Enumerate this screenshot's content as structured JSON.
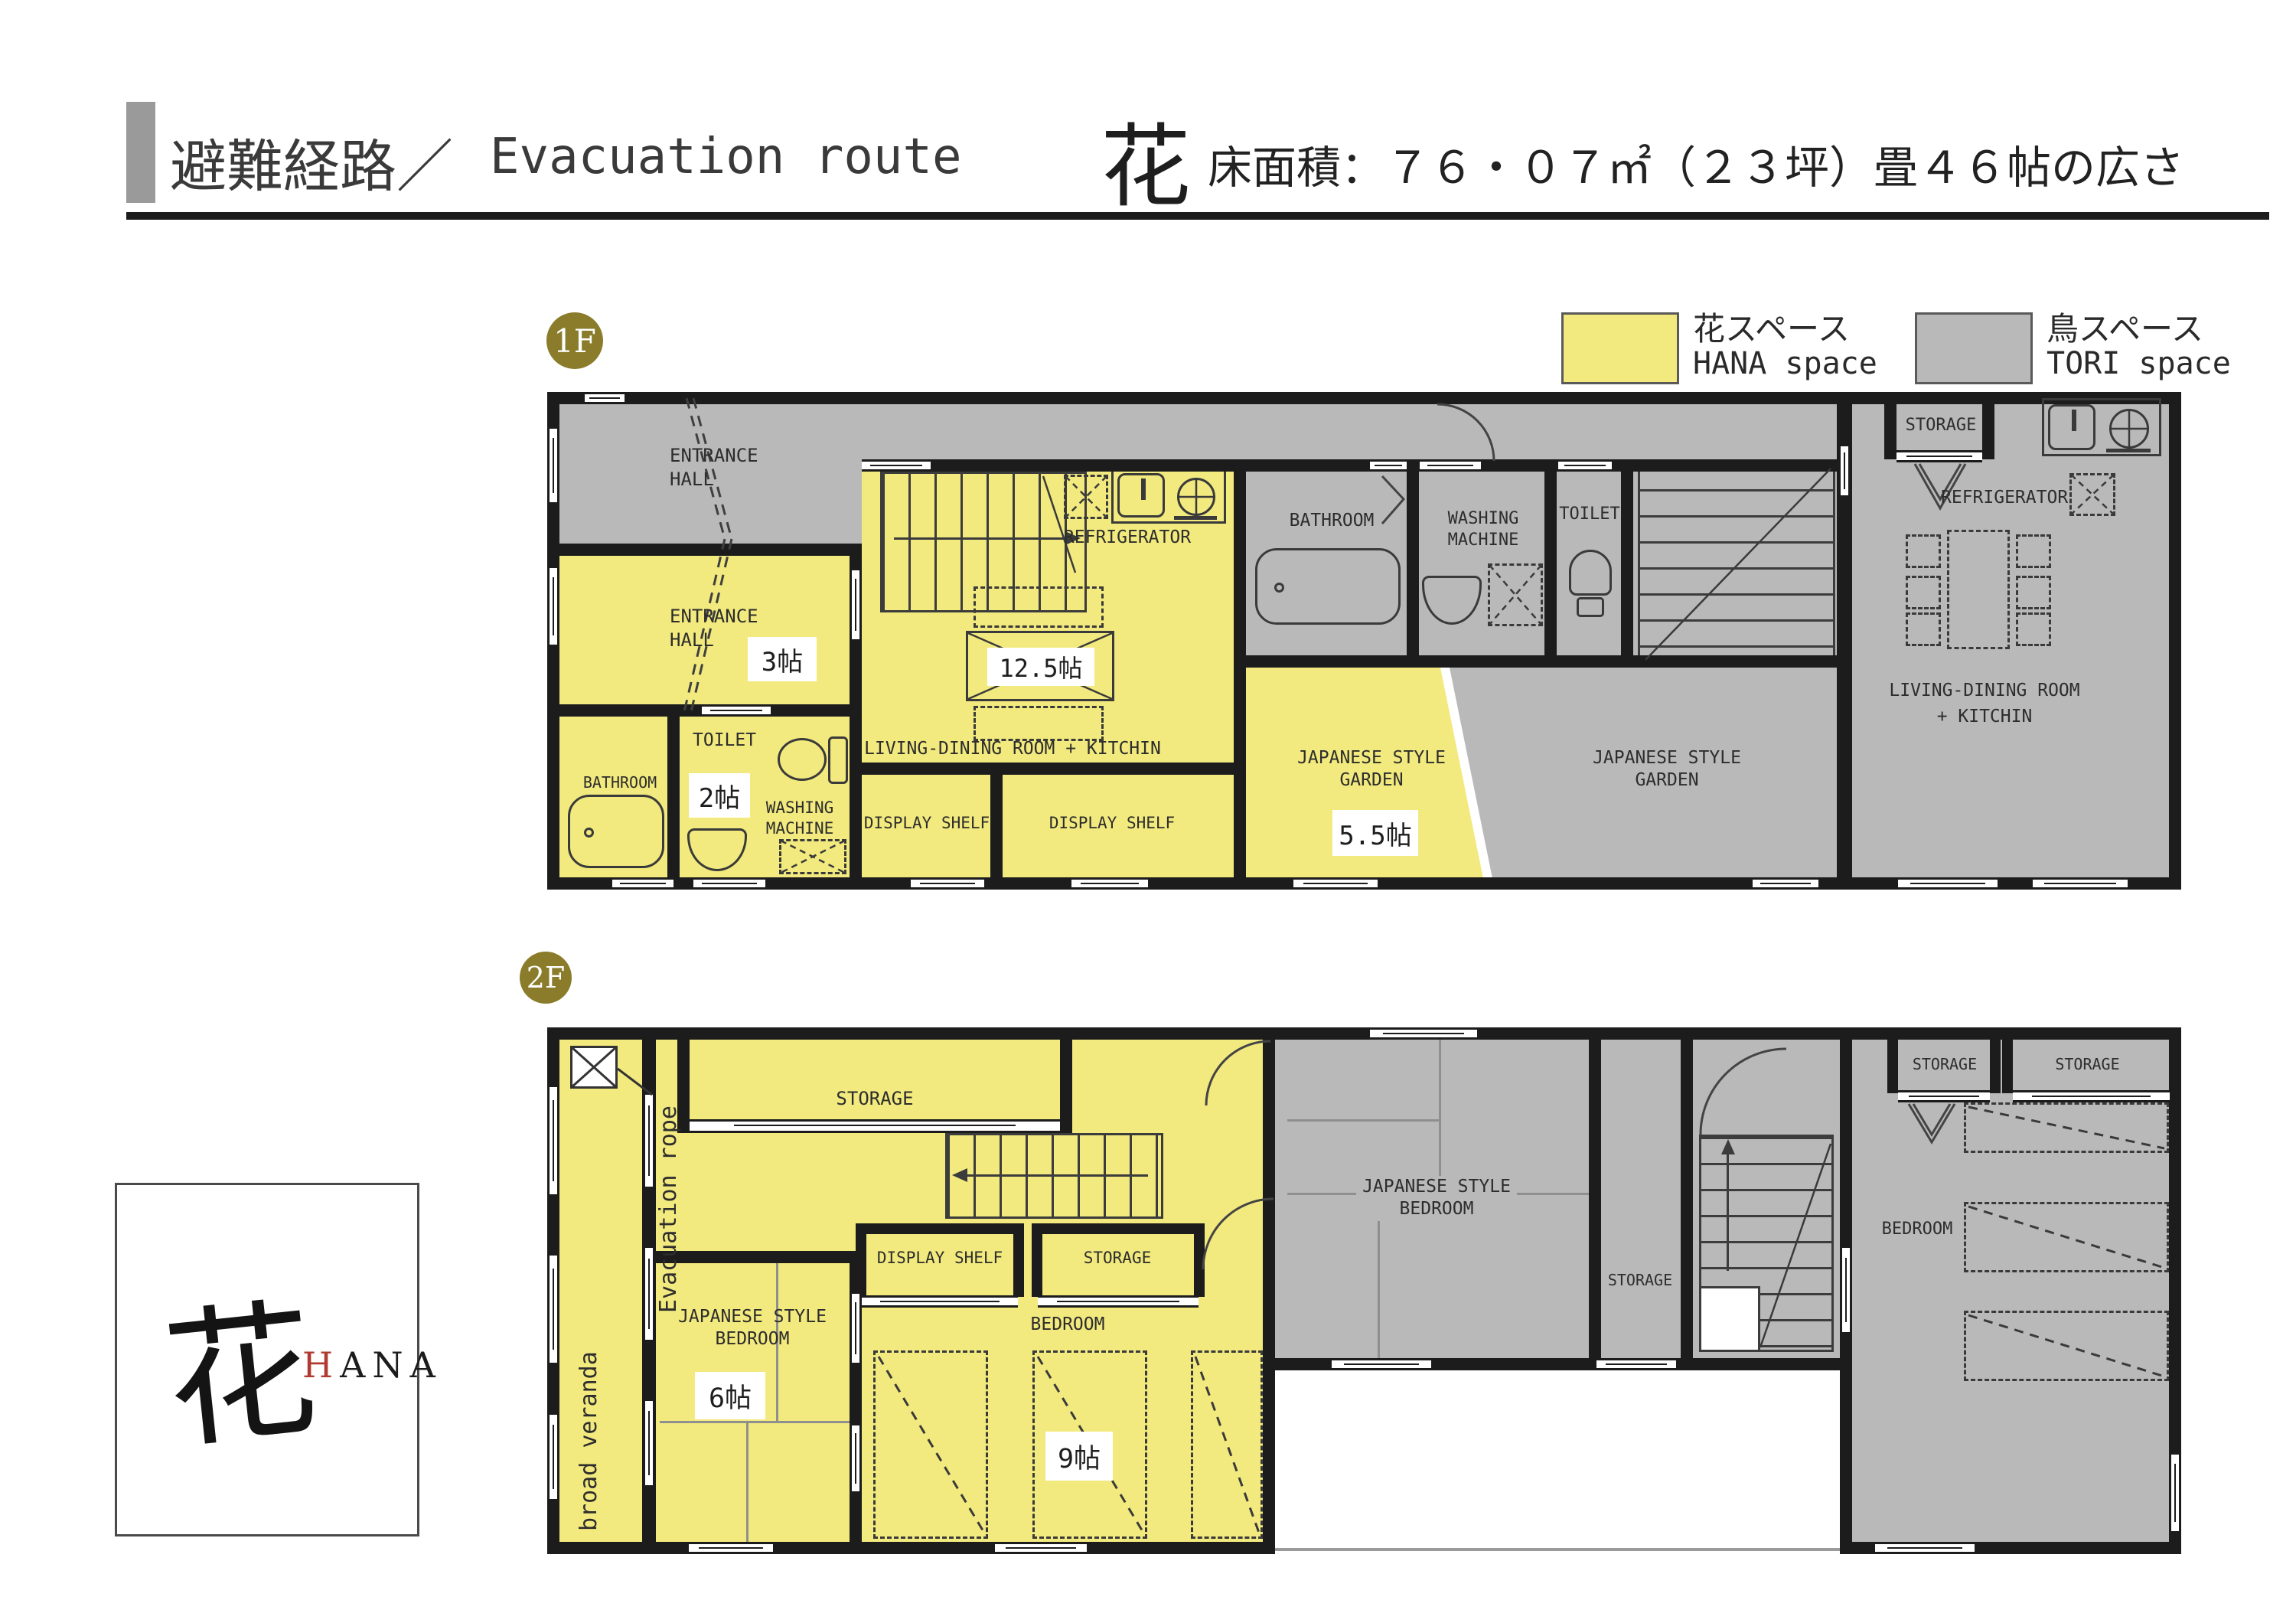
{
  "header": {
    "title_jp": "避難経路／",
    "title_en": "Evacuation route",
    "unit_kanji": "花",
    "area_spec": "床面積：７６・０７㎡（２３坪）畳４６帖の広さ"
  },
  "legend": {
    "hana": {
      "label_jp": "花スペース",
      "label_en": "HANA space",
      "color": "#f2ea7e"
    },
    "tori": {
      "label_jp": "鳥スペース",
      "label_en": "TORI space",
      "color": "#b9b9b9"
    }
  },
  "floor1": {
    "badge": "1F",
    "tori_entrance_hall": "ENTRANCE HALL",
    "hana_entrance_hall": "ENTRANCE HALL",
    "hana_entrance_size": "3帖",
    "hana_bathroom": "BATHROOM",
    "hana_toilet": "TOILET",
    "hana_toilet_size": "2帖",
    "hana_washing": "WASHING MACHINE",
    "hana_refrigerator": "REFRIGERATOR",
    "hana_table_size": "12.5帖",
    "hana_ldk": "LIVING-DINING ROOM + KITCHIN",
    "display_shelf_left": "DISPLAY SHELF",
    "display_shelf_right": "DISPLAY SHELF",
    "tori_bathroom": "BATHROOM",
    "tori_washing": "WASHING MACHINE",
    "tori_toilet": "TOILET",
    "hana_garden": "JAPANESE STYLE GARDEN",
    "hana_garden_size": "5.5帖",
    "tori_garden": "JAPANESE STYLE GARDEN",
    "tori_storage": "STORAGE",
    "tori_refrigerator": "REFRIGERATOR",
    "tori_ldk_1": "LIVING-DINING ROOM",
    "tori_ldk_2": "+ KITCHIN"
  },
  "floor2": {
    "badge": "2F",
    "evacuation_rope": "Evacuation rope",
    "broad_veranda": "broad veranda",
    "hana_storage": "STORAGE",
    "hana_jsb": "JAPANESE STYLE BEDROOM",
    "hana_jsb_size": "6帖",
    "display_shelf": "DISPLAY SHELF",
    "hana_storage_small": "STORAGE",
    "hana_bedroom": "BEDROOM",
    "hana_bedroom_size": "9帖",
    "tori_jsb": "JAPANESE STYLE BEDROOM",
    "tori_storage_mid": "STORAGE",
    "tori_storage_1": "STORAGE",
    "tori_storage_2": "STORAGE",
    "tori_bedroom": "BEDROOM"
  },
  "logo": {
    "kanji": "花",
    "latin_first": "H",
    "latin_rest": "ANA"
  }
}
